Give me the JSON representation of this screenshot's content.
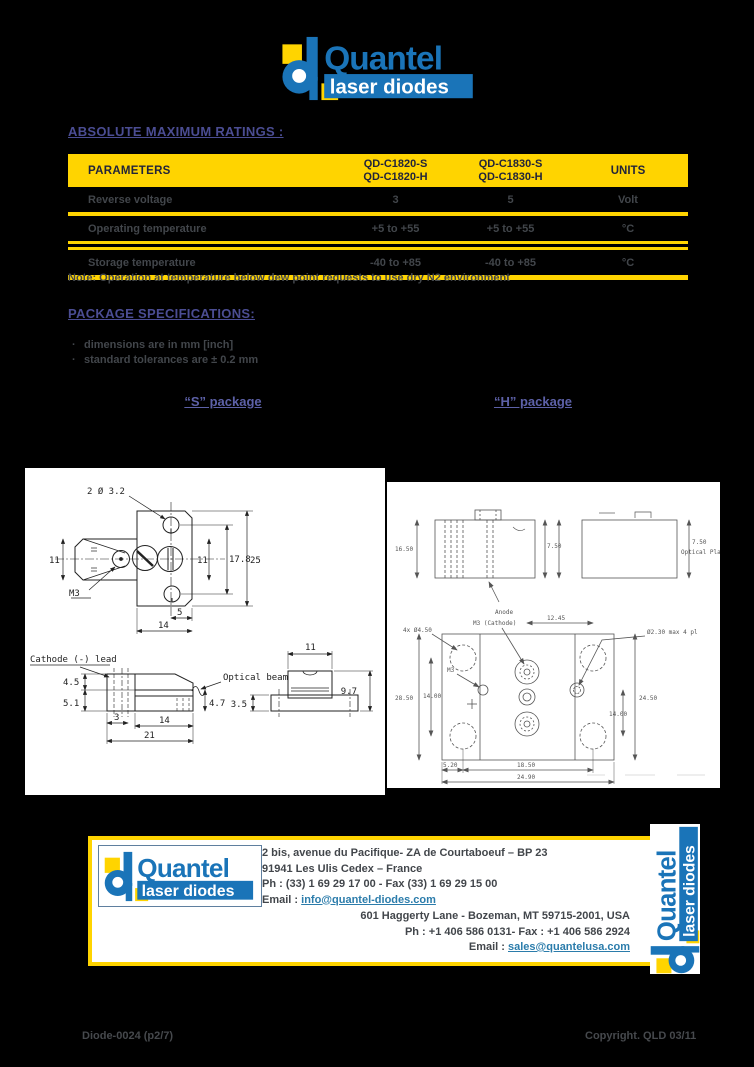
{
  "page": {
    "background": "#000000",
    "accent_yellow": "#ffd400",
    "heading_purple": "#4b4d93",
    "logo_blue": "#1a74b8",
    "link_blue": "#2b7cab",
    "body_text": "#42464b"
  },
  "logo": {
    "brand": "Quantel",
    "subtitle": "laser diodes"
  },
  "ratings": {
    "title": "ABSOLUTE MAXIMUM RATINGS :",
    "table": {
      "col_parameters": "PARAMETERS",
      "col_model1_line1": "QD-C1820-S",
      "col_model1_line2": "QD-C1820-H",
      "col_model2_line1": "QD-C1830-S",
      "col_model2_line2": "QD-C1830-H",
      "col_units": "UNITS",
      "rows": [
        {
          "parameter": "Reverse voltage",
          "model1": "3",
          "model2": "5",
          "unit": "Volt"
        },
        {
          "parameter": "Operating temperature",
          "model1": "+5 to +55",
          "model2": "+5 to +55",
          "unit": "°C"
        },
        {
          "parameter": "Storage temperature",
          "model1": "-40 to +85",
          "model2": "-40 to +85",
          "unit": "°C"
        }
      ]
    },
    "note": "Note: Operation at temperature below dew point requests to use dry N2 environment"
  },
  "package_specs": {
    "title": "PACKAGE SPECIFICATIONS:",
    "bullets": [
      "dimensions are in mm  [inch]",
      "standard tolerances are ± 0.2 mm"
    ],
    "s_label": "“S” package",
    "h_label": "“H” package"
  },
  "drawing_s": {
    "hole_note": "2 Ø 3.2",
    "m3": "M3",
    "dim_11_left": "11",
    "dim_11_right": "11",
    "dim_178": "17.8",
    "dim_25": "25",
    "dim_5": "5",
    "dim_14_top": "14",
    "cathode_lead": "Cathode  (-)  lead",
    "optical_beam": "Optical  beam",
    "dim_45": "4.5",
    "dim_51": "5.1",
    "dim_3": "3",
    "dim_14_side": "14",
    "dim_21": "21",
    "dim_47": "4.7",
    "dim_11_end": "11",
    "dim_97": "9.7",
    "dim_35": "3.5"
  },
  "drawing_h": {
    "anode": "Anode",
    "m3_cathode": "M3 (Cathode)",
    "holes_note": "4x Ø4.50",
    "pins_note": "Ø2.30 max 4 pl",
    "m3": "M3",
    "dim_1650": "16.50",
    "dim_750_mid": "7.50",
    "dim_750_right": "7.50",
    "optical_plane": "Optical Plane",
    "dim_1245": "12.45",
    "dim_2450": "24.50",
    "dim_1400_right": "14.00",
    "dim_2850": "28.50",
    "dim_1400_left": "14.00",
    "dim_520": "5.20",
    "dim_1850": "18.50",
    "dim_2490": "24.90"
  },
  "footer": {
    "fr_address1": "2 bis, avenue du Pacifique- ZA de Courtaboeuf – BP 23",
    "fr_address2": "91941 Les Ulis Cedex – France",
    "fr_phone": "Ph : (33) 1 69 29 17 00 - Fax (33) 1 69 29 15 00",
    "fr_email_label": "Email :",
    "fr_email": "info@quantel-diodes.com",
    "us_address": "601 Haggerty Lane -  Bozeman, MT 59715-2001, USA",
    "us_phone": "Ph : +1 406 586 0131- Fax : +1 406 586 2924",
    "us_email_label": "Email :",
    "us_email": "sales@quantelusa.com"
  },
  "footnote": {
    "doc_ref": "Diode-0024 (p2/7)",
    "copyright": "Copyright. QLD 03/11"
  }
}
